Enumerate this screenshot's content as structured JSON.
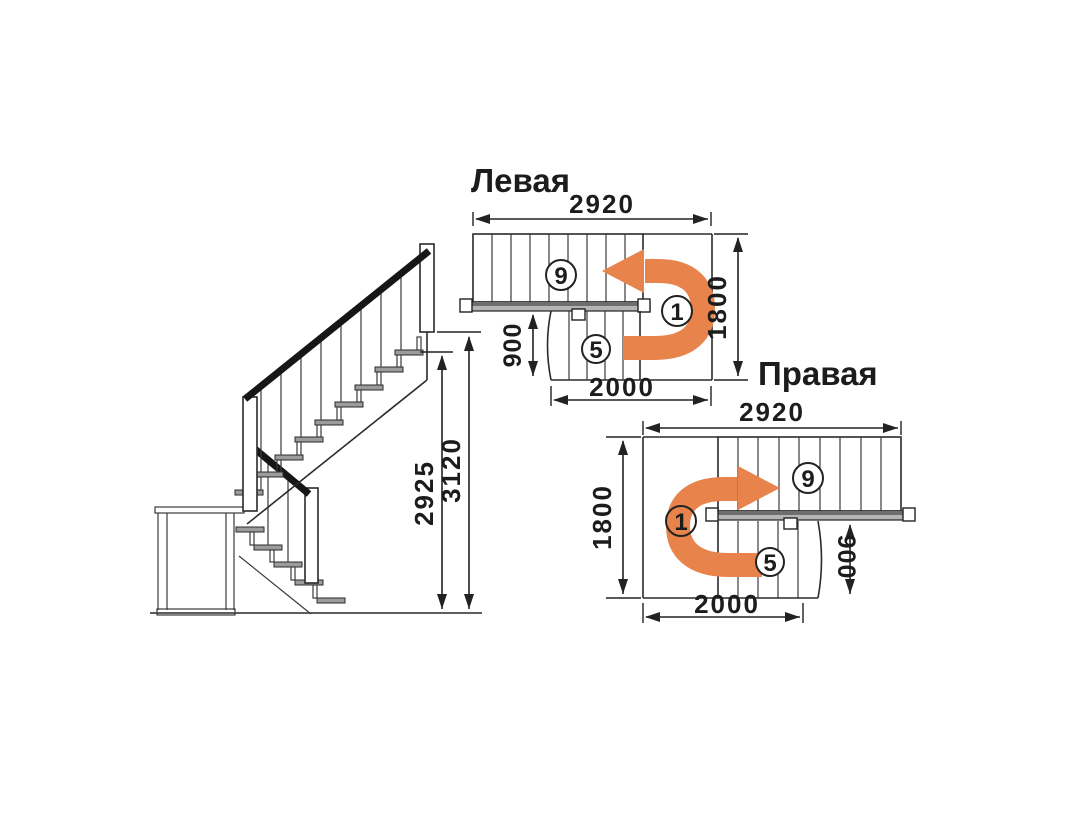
{
  "colors": {
    "background": "#ffffff",
    "line": "#2a2a2a",
    "arrow_orange": "#e8834c",
    "tread_gray": "#9c9c9c",
    "landing_bar_gray": "#b5b5b5",
    "rail_black": "#161616"
  },
  "elevation": {
    "dim_height_total": "3120",
    "dim_height_floor": "2925"
  },
  "plans": {
    "left": {
      "title": "Левая",
      "dim_width": "2920",
      "dim_depth": "1800",
      "dim_flight": "900",
      "dim_run": "2000",
      "label_upper_steps": "9",
      "label_lower_steps": "5",
      "label_start_step": "1"
    },
    "right": {
      "title": "Правая",
      "dim_width": "2920",
      "dim_depth": "1800",
      "dim_flight": "900",
      "dim_run": "2000",
      "label_upper_steps": "9",
      "label_lower_steps": "5",
      "label_start_step": "1"
    }
  }
}
